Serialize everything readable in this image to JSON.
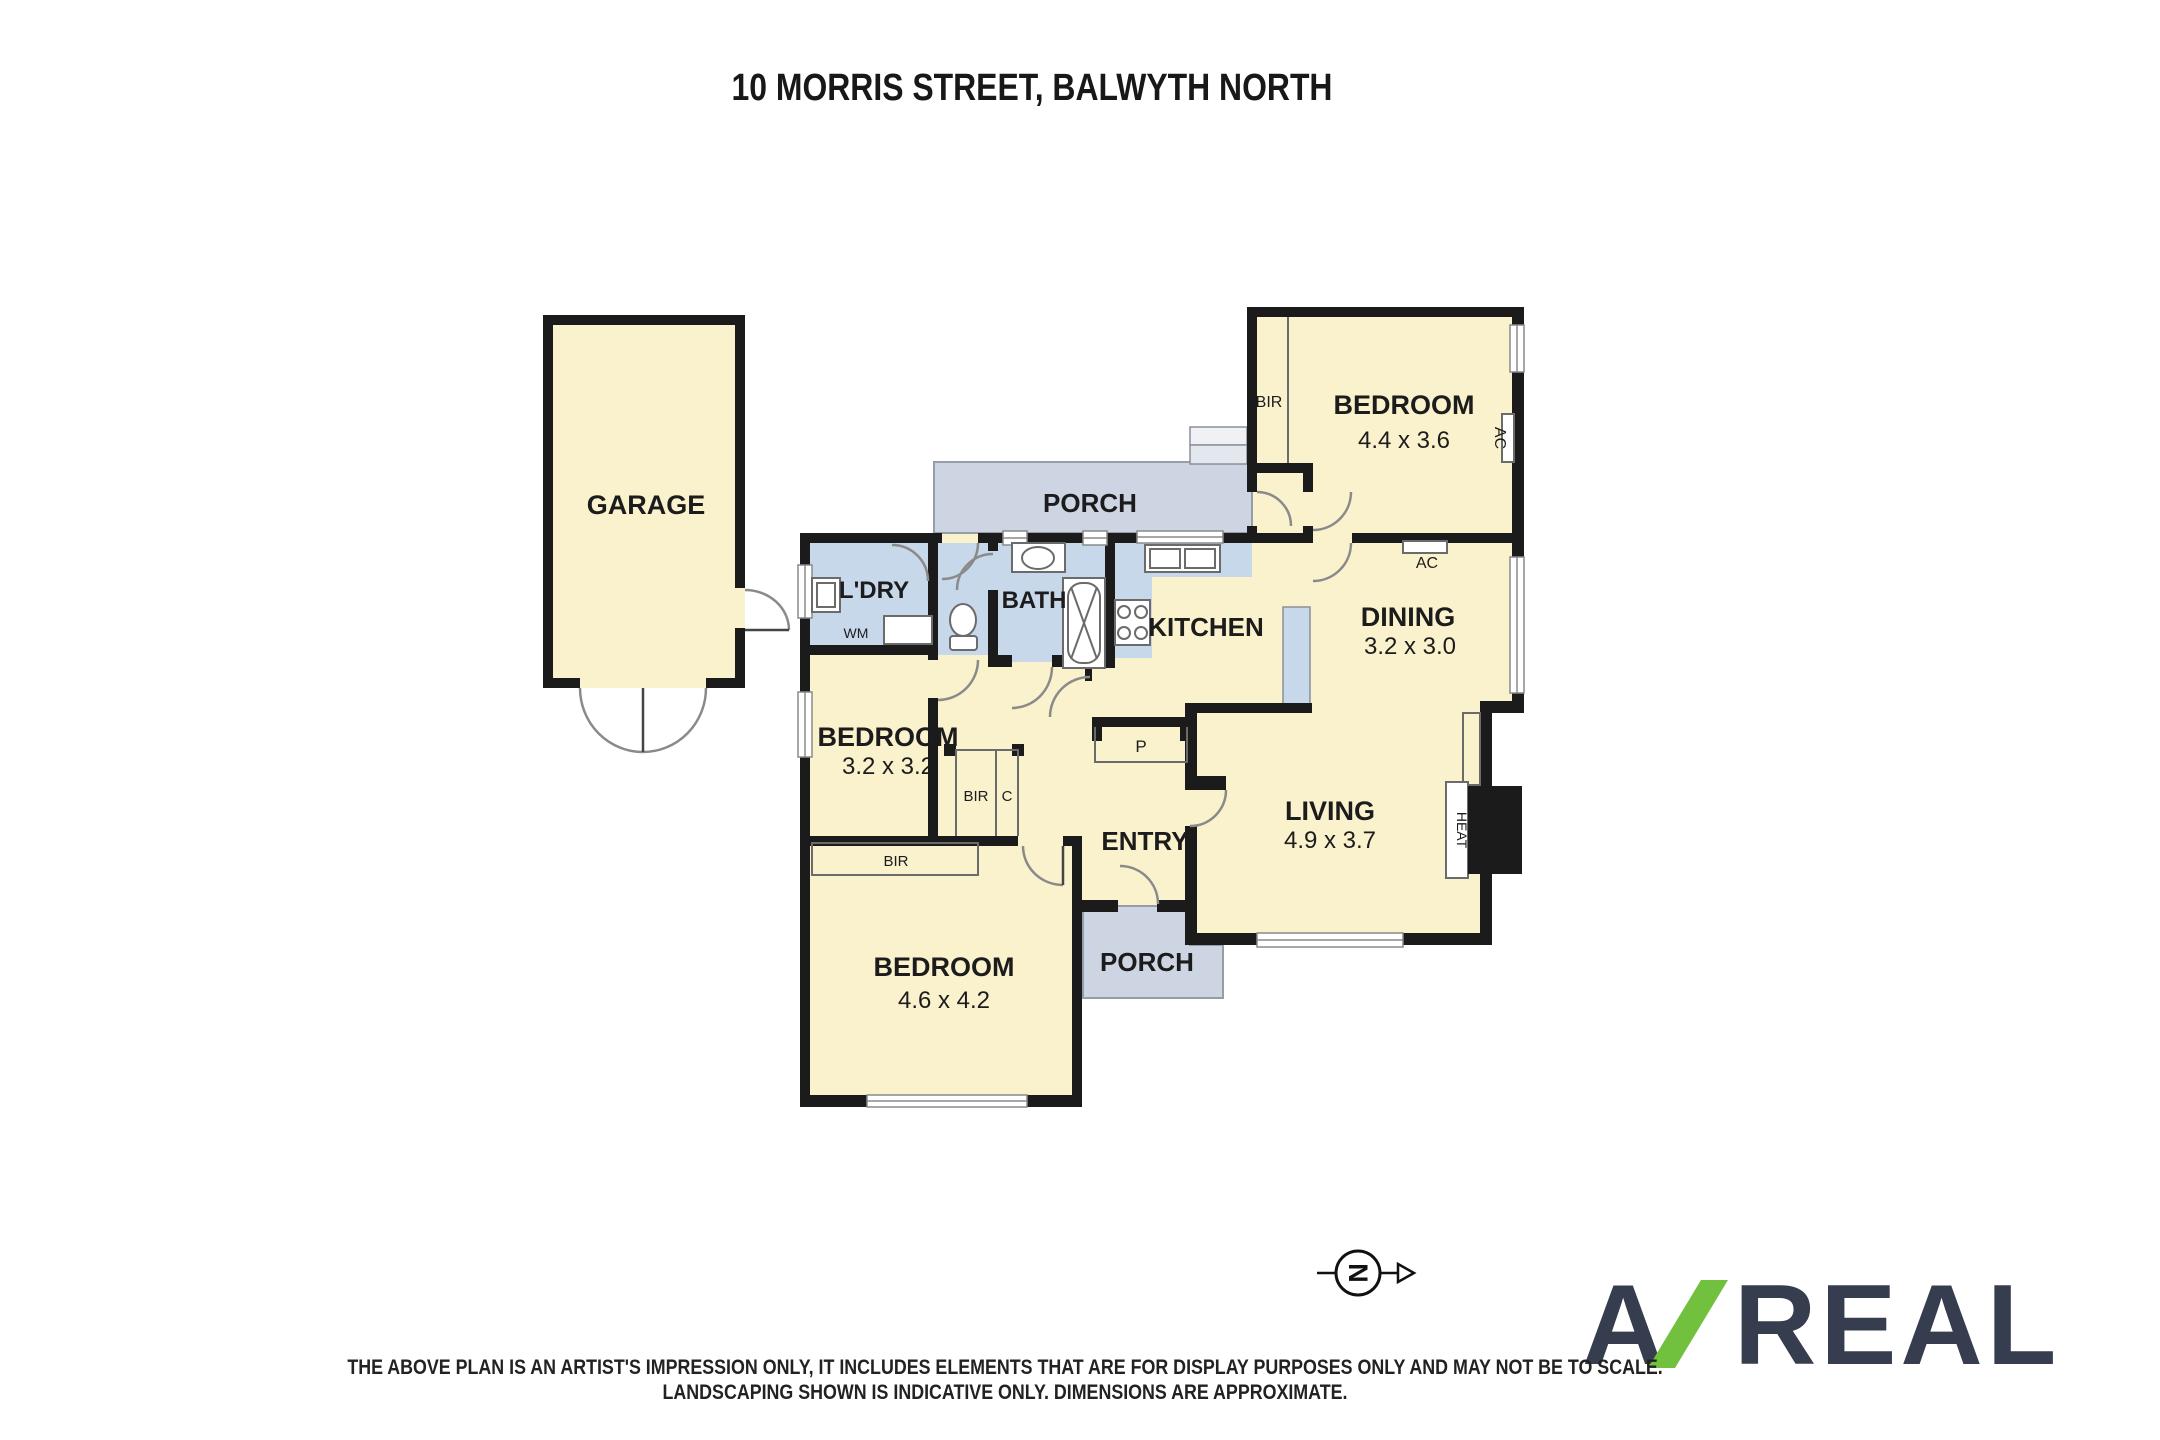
{
  "title": "10 MORRIS STREET, BALWYTH NORTH",
  "rooms": {
    "garage": {
      "name": "GARAGE"
    },
    "porch_top": {
      "name": "PORCH"
    },
    "laundry": {
      "name": "L'DRY"
    },
    "bath": {
      "name": "BATH"
    },
    "kitchen": {
      "name": "KITCHEN"
    },
    "bedroom_ne": {
      "name": "BEDROOM",
      "dims": "4.4 x 3.6"
    },
    "dining": {
      "name": "DINING",
      "dims": "3.2 x 3.0"
    },
    "bedroom_w": {
      "name": "BEDROOM",
      "dims": "3.2 x 3.2"
    },
    "entry": {
      "name": "ENTRY"
    },
    "living": {
      "name": "LIVING",
      "dims": "4.9 x 3.7"
    },
    "bedroom_sw": {
      "name": "BEDROOM",
      "dims": "4.6 x 4.2"
    },
    "porch_bottom": {
      "name": "PORCH"
    }
  },
  "fixtures": {
    "bir_ne": "BIR",
    "bir_hall": "BIR",
    "closet": "C",
    "bir_sw": "BIR",
    "wm": "WM",
    "pantry": "P",
    "ac_wall": "AC",
    "ac_side": "AC",
    "heat": "HEAT"
  },
  "compass": {
    "north": "N"
  },
  "logo": {
    "first": "A",
    "rest": "REAL"
  },
  "disclaimer": {
    "line1": "THE ABOVE PLAN IS AN ARTIST'S IMPRESSION ONLY, IT INCLUDES ELEMENTS THAT ARE FOR DISPLAY PURPOSES ONLY AND MAY NOT BE TO SCALE.",
    "line2": "LANDSCAPING SHOWN IS INDICATIVE ONLY. DIMENSIONS ARE APPROXIMATE."
  },
  "colors": {
    "room_fill": "#FAF1CD",
    "wet_fill": "#C7D8EB",
    "porch_fill": "#CDD5E3",
    "wall": "#1b1b1b",
    "logo_navy": "#363D4E",
    "logo_green": "#72C13E"
  }
}
